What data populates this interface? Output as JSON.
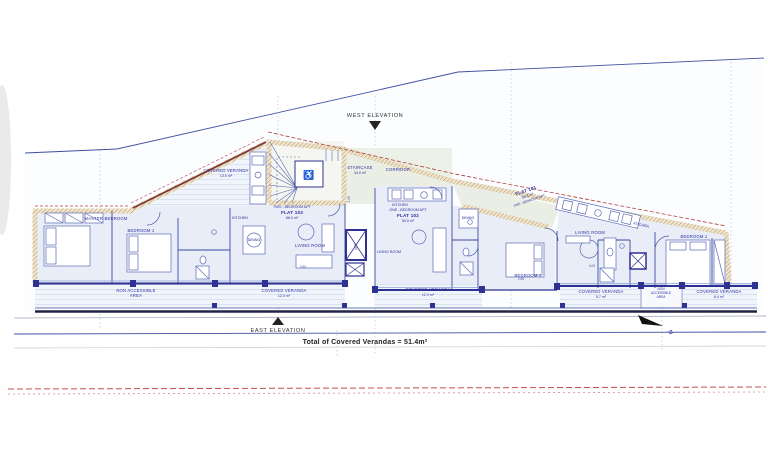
{
  "markers": {
    "west_elevation": "WEST ELEVATION",
    "east_elevation": "EAST ELEVATION",
    "north": "N"
  },
  "summary": {
    "total": "Total of Covered Verandas = 51.4m²"
  },
  "flat103": {
    "type": "TWO - BEDROOM APT",
    "name": "FLAT 103",
    "area": "86.0 m²"
  },
  "flat102": {
    "type": "ONE - BEDROOM APT",
    "name": "FLAT 102",
    "area": "50.0 m²"
  },
  "flat101": {
    "name": "FLAT 101",
    "area": "56.8 m²",
    "type": "ONE - BEDROOM APT"
  },
  "rooms": {
    "master_bedroom": "MASTER BEDROOM",
    "bedroom1": "BEDROOM 1",
    "kitchen": "KITCHEN",
    "dining": "DINING",
    "living_room": "LIVING ROOM",
    "corridor": "CORRIDOR",
    "staircase": "STAIRCASE",
    "staircase_area": "34.0 m²",
    "lift": "LIFT"
  },
  "verandas": {
    "covered": "COVERED VERANDA",
    "v1_area": "13.0 m²",
    "v2_area": "12.0 m²",
    "v3_area": "12.3 m²",
    "v4_area": "5.7 m²",
    "v5_area": "8.4 m²",
    "non_accessible_l1": "NON ACCESSIBLE",
    "non_accessible_l2": "AREA",
    "na_w1": "NON",
    "na_w2": "ACCESSIBLE",
    "na_w3": "AREA"
  },
  "dims": {
    "d1": "1.00",
    "d2": "4.05",
    "d3": "3.85",
    "d4": "2.85"
  },
  "colors": {
    "navy": "#2e3192",
    "label_blue": "#2b2fa0",
    "wall_tan": "#a5834f",
    "red_dashed": "#c0504d"
  }
}
